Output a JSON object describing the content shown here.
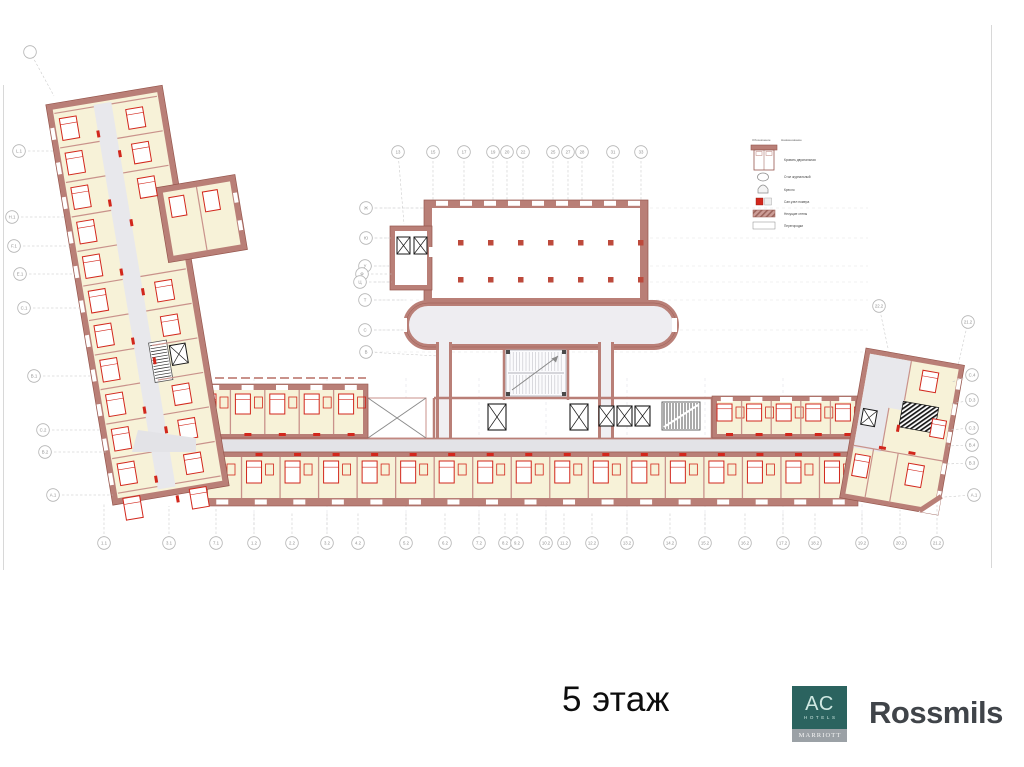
{
  "footer": {
    "floor_label": "5 этаж",
    "brand": "Rossmils"
  },
  "ac_logo": {
    "letters": "AC",
    "hotels": "HOTELS",
    "marriott": "MARRIOTT",
    "teal": "#2b635f",
    "band_gray": "#9ba1a6"
  },
  "colors": {
    "wall": "#b97f77",
    "wall_dark": "#96564d",
    "wall_light": "#c9928b",
    "accent_red": "#d2271c",
    "room": "#f7f2d8",
    "corridor": "#e3e3e7",
    "stair_hatch": "#161616",
    "grid_text": "#8f8f8f",
    "brand_text": "#404449"
  },
  "plan": {
    "legend": {
      "col_symbol": "Обозначение",
      "col_name": "Наименование",
      "items": [
        {
          "icon": "bed-icon",
          "label": "Кровать двуспальная"
        },
        {
          "icon": "table-icon",
          "label": "Стол журнальный"
        },
        {
          "icon": "armchair-icon",
          "label": "Кресло"
        },
        {
          "icon": "bathroom-icon",
          "label": "Сан.узел номера"
        },
        {
          "icon": "bearing-wall-icon",
          "label": "Несущие стены"
        },
        {
          "icon": "partition-icon",
          "label": "Перегородки"
        }
      ]
    },
    "grid_markers": {
      "top": [
        {
          "label": "13",
          "x": 398,
          "y": 152,
          "lx": 404,
          "ly": 224
        },
        {
          "label": "15",
          "x": 433,
          "y": 152,
          "lx": 433,
          "ly": 200
        },
        {
          "label": "17",
          "x": 464,
          "y": 152,
          "lx": 464,
          "ly": 200
        },
        {
          "label": "19",
          "x": 493,
          "y": 152,
          "lx": 493,
          "ly": 200
        },
        {
          "label": "20",
          "x": 507,
          "y": 152,
          "lx": 507,
          "ly": 200
        },
        {
          "label": "22",
          "x": 523,
          "y": 152,
          "lx": 523,
          "ly": 200
        },
        {
          "label": "25",
          "x": 553,
          "y": 152,
          "lx": 553,
          "ly": 200
        },
        {
          "label": "27",
          "x": 568,
          "y": 152,
          "lx": 568,
          "ly": 200
        },
        {
          "label": "28",
          "x": 582,
          "y": 152,
          "lx": 582,
          "ly": 200
        },
        {
          "label": "31",
          "x": 613,
          "y": 152,
          "lx": 613,
          "ly": 200
        },
        {
          "label": "33",
          "x": 641,
          "y": 152,
          "lx": 641,
          "ly": 200
        }
      ],
      "hall_left": [
        {
          "label": "Ж",
          "x": 366,
          "y": 208,
          "lx": 424,
          "ly": 208
        },
        {
          "label": "Ю",
          "x": 366,
          "y": 238,
          "lx": 392,
          "ly": 238
        },
        {
          "label": "У",
          "x": 365,
          "y": 266,
          "lx": 392,
          "ly": 266
        },
        {
          "label": "Ф",
          "x": 362,
          "y": 274,
          "lx": 392,
          "ly": 274
        },
        {
          "label": "Ц",
          "x": 360,
          "y": 282,
          "lx": 392,
          "ly": 282
        },
        {
          "label": "Т",
          "x": 365,
          "y": 300,
          "lx": 406,
          "ly": 300
        },
        {
          "label": "С",
          "x": 365,
          "y": 330,
          "lx": 406,
          "ly": 330
        },
        {
          "label": "В",
          "x": 366,
          "y": 352,
          "lx": 438,
          "ly": 356
        }
      ],
      "left": [
        {
          "label": "L.1",
          "x": 19,
          "y": 151,
          "lx": 54,
          "ly": 151
        },
        {
          "label": "H.1",
          "x": 12,
          "y": 217,
          "lx": 66,
          "ly": 217
        },
        {
          "label": "F.1",
          "x": 14,
          "y": 246,
          "lx": 71,
          "ly": 246
        },
        {
          "label": "E.1",
          "x": 20,
          "y": 274,
          "lx": 75,
          "ly": 274
        },
        {
          "label": "C.1",
          "x": 24,
          "y": 308,
          "lx": 81,
          "ly": 308
        },
        {
          "label": "B.1",
          "x": 34,
          "y": 376,
          "lx": 93,
          "ly": 376
        },
        {
          "label": "C.2",
          "x": 43,
          "y": 430,
          "lx": 102,
          "ly": 430
        },
        {
          "label": "B.2",
          "x": 45,
          "y": 452,
          "lx": 106,
          "ly": 452
        },
        {
          "label": "A.1",
          "x": 53,
          "y": 495,
          "lx": 113,
          "ly": 495
        }
      ],
      "right": [
        {
          "label": "22.2",
          "x": 879,
          "y": 306,
          "lx": 888,
          "ly": 348
        },
        {
          "label": "21.2",
          "x": 968,
          "y": 322,
          "lx": 958,
          "ly": 366
        },
        {
          "label": "C.4",
          "x": 972,
          "y": 375,
          "lx": 952,
          "ly": 382
        },
        {
          "label": "D.3",
          "x": 972,
          "y": 400,
          "lx": 950,
          "ly": 404
        },
        {
          "label": "C.3",
          "x": 972,
          "y": 428,
          "lx": 948,
          "ly": 430
        },
        {
          "label": "B.4",
          "x": 972,
          "y": 445,
          "lx": 948,
          "ly": 446
        },
        {
          "label": "B.3",
          "x": 972,
          "y": 463,
          "lx": 946,
          "ly": 464
        },
        {
          "label": "A.1",
          "x": 974,
          "y": 495,
          "lx": 944,
          "ly": 497
        }
      ],
      "bottom": [
        {
          "label": "1.1",
          "x": 104,
          "y": 543,
          "lx": 104,
          "ly": 504
        },
        {
          "label": "3.1",
          "x": 169,
          "y": 543,
          "lx": 169,
          "ly": 506
        },
        {
          "label": "7.1",
          "x": 216,
          "y": 543,
          "lx": 216,
          "ly": 508
        },
        {
          "label": "1.2",
          "x": 254,
          "y": 543,
          "lx": 254,
          "ly": 512
        },
        {
          "label": "2.2",
          "x": 292,
          "y": 543,
          "lx": 292,
          "ly": 512
        },
        {
          "label": "3.2",
          "x": 327,
          "y": 543,
          "lx": 327,
          "ly": 512
        },
        {
          "label": "4.2",
          "x": 358,
          "y": 543,
          "lx": 358,
          "ly": 512
        },
        {
          "label": "5.2",
          "x": 406,
          "y": 543,
          "lx": 406,
          "ly": 512
        },
        {
          "label": "6.2",
          "x": 445,
          "y": 543,
          "lx": 445,
          "ly": 512
        },
        {
          "label": "7.2",
          "x": 479,
          "y": 543,
          "lx": 479,
          "ly": 512
        },
        {
          "label": "8.2",
          "x": 505,
          "y": 543,
          "lx": 505,
          "ly": 512
        },
        {
          "label": "9.2",
          "x": 517,
          "y": 543,
          "lx": 517,
          "ly": 512
        },
        {
          "label": "10.2",
          "x": 546,
          "y": 543,
          "lx": 546,
          "ly": 512
        },
        {
          "label": "11.2",
          "x": 564,
          "y": 543,
          "lx": 564,
          "ly": 512
        },
        {
          "label": "12.2",
          "x": 592,
          "y": 543,
          "lx": 592,
          "ly": 512
        },
        {
          "label": "13.2",
          "x": 627,
          "y": 543,
          "lx": 627,
          "ly": 512
        },
        {
          "label": "14.2",
          "x": 670,
          "y": 543,
          "lx": 670,
          "ly": 512
        },
        {
          "label": "15.2",
          "x": 705,
          "y": 543,
          "lx": 705,
          "ly": 512
        },
        {
          "label": "16.2",
          "x": 745,
          "y": 543,
          "lx": 745,
          "ly": 512
        },
        {
          "label": "17.2",
          "x": 783,
          "y": 543,
          "lx": 783,
          "ly": 512
        },
        {
          "label": "18.2",
          "x": 815,
          "y": 543,
          "lx": 815,
          "ly": 512
        },
        {
          "label": "19.2",
          "x": 862,
          "y": 543,
          "lx": 862,
          "ly": 512
        },
        {
          "label": "20.2",
          "x": 900,
          "y": 543,
          "lx": 900,
          "ly": 510
        },
        {
          "label": "21.2",
          "x": 937,
          "y": 543,
          "lx": 937,
          "ly": 505
        }
      ],
      "misc": [
        {
          "label": "",
          "x": 30,
          "y": 52,
          "lx": 54,
          "ly": 96
        }
      ]
    }
  }
}
